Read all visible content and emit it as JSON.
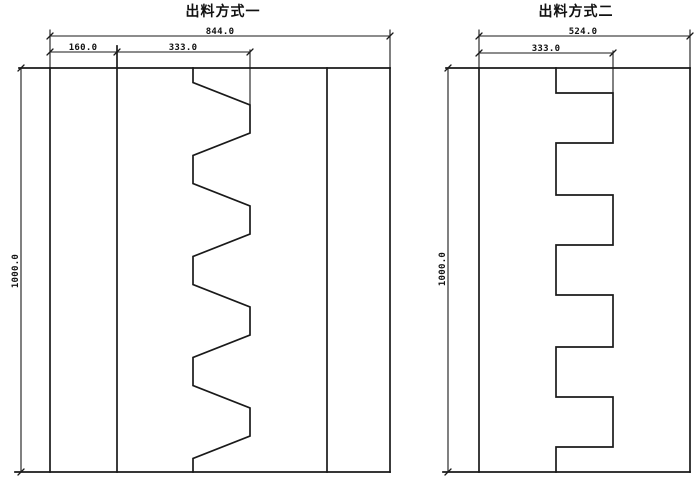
{
  "canvas": {
    "background": "#ffffff",
    "line_color": "#1a1a1a"
  },
  "diagrams": {
    "method_one": {
      "title": "出料方式一",
      "profile": "trapezoidal-zigzag-teeth",
      "dims": {
        "total_width": "844.0",
        "left_band": "160.0",
        "teeth_span": "333.0",
        "height": "1000.0"
      }
    },
    "method_two": {
      "title": "出料方式二",
      "profile": "square-castellated-teeth",
      "dims": {
        "total_width": "524.0",
        "teeth_span": "333.0",
        "height": "1000.0"
      }
    }
  }
}
